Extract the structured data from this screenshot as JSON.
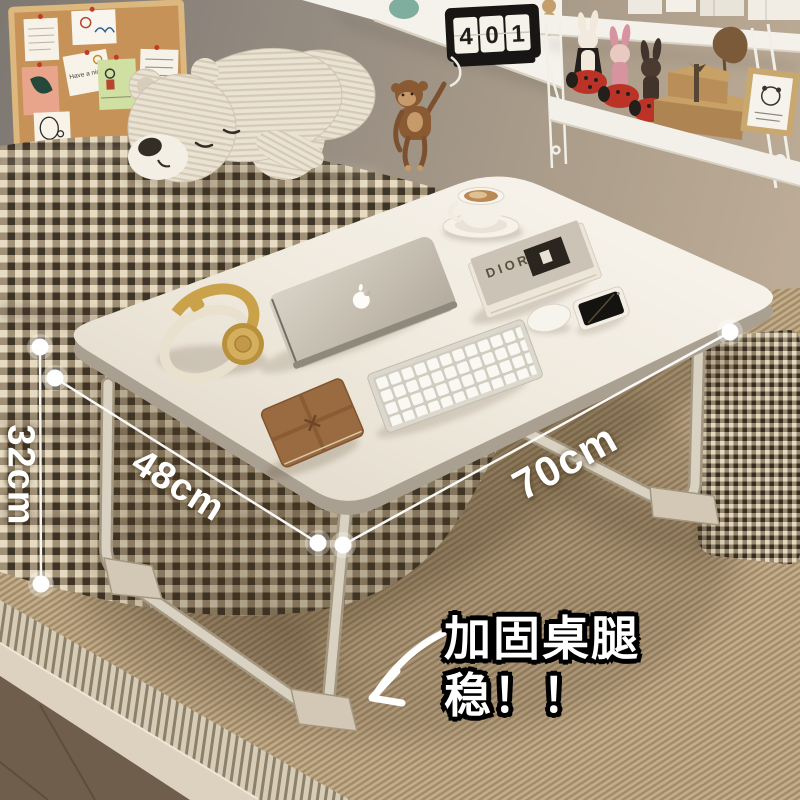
{
  "annotations": {
    "width_label": "70cm",
    "depth_label": "48cm",
    "height_label": "32cm",
    "callout_line1": "加固桌腿",
    "callout_line2": "稳！！"
  },
  "props": {
    "book_title": "DIOR",
    "corkboard_note": "Have a nice day",
    "calendar_digits": [
      "4",
      "0",
      "1"
    ]
  },
  "colors": {
    "annotation_text": "#ffffff",
    "callout_outline": "#000000",
    "desk_top": "#efe9df",
    "headphones_gold": "#c9a24a",
    "ladybug_red": "#bb3327",
    "gingham_dark": "#3c3426",
    "sheet_tan": "#c2ac8a"
  },
  "objects": {
    "scene": [
      "cork-board",
      "teddy-bear",
      "wooden-monkey",
      "flip-calendar",
      "string-shelf",
      "bunny-figurines",
      "gift-boxes",
      "photo-frame",
      "gingham-pillows",
      "striped-sheet",
      "folding-lap-desk"
    ],
    "on_desk": [
      "coffee-cup",
      "book-stack",
      "macbook-laptop",
      "headphones",
      "leather-journal",
      "keyboard",
      "mouse",
      "smartphone"
    ]
  }
}
